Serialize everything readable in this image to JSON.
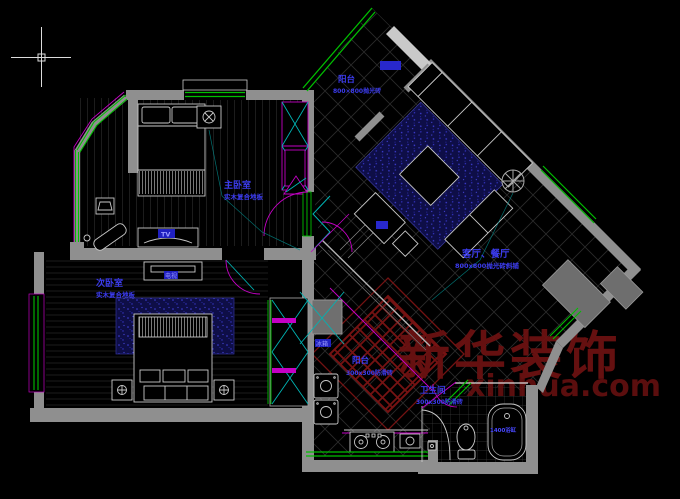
{
  "watermark": {
    "brand": "新华装饰",
    "domain": "xinhua.com",
    "color": "#6b1111"
  },
  "rooms": {
    "master_bedroom": {
      "label": "主卧室",
      "finish": "实木复合地板"
    },
    "second_bedroom": {
      "label": "次卧室",
      "finish": "实木复合地板"
    },
    "living_dining": {
      "label": "客厅、餐厅",
      "finish": "800x800抛光砖斜铺"
    },
    "balcony_top": {
      "label": "阳台",
      "finish": "800×800抛光砖"
    },
    "balcony_bottom": {
      "label": "阳台",
      "finish": "300x300防滑砖"
    },
    "bathroom": {
      "label": "卫生间",
      "finish": "300x300防滑砖"
    }
  },
  "tags": {
    "tv_dresser": "TV",
    "tv_cabinet": "电视",
    "fridge": "冰箱",
    "bathtub": "1400浴缸"
  },
  "colors": {
    "wall": "#8f8f8f",
    "window": "#00c000",
    "door_accent": "#c400c4",
    "cabinet_x": "#00b4b4",
    "furniture": "#c8c8c8",
    "label": "#3c3cf0",
    "grid": "#2b2b2b",
    "rug": "#0e0e47",
    "watermark_red": "#6b1111"
  }
}
